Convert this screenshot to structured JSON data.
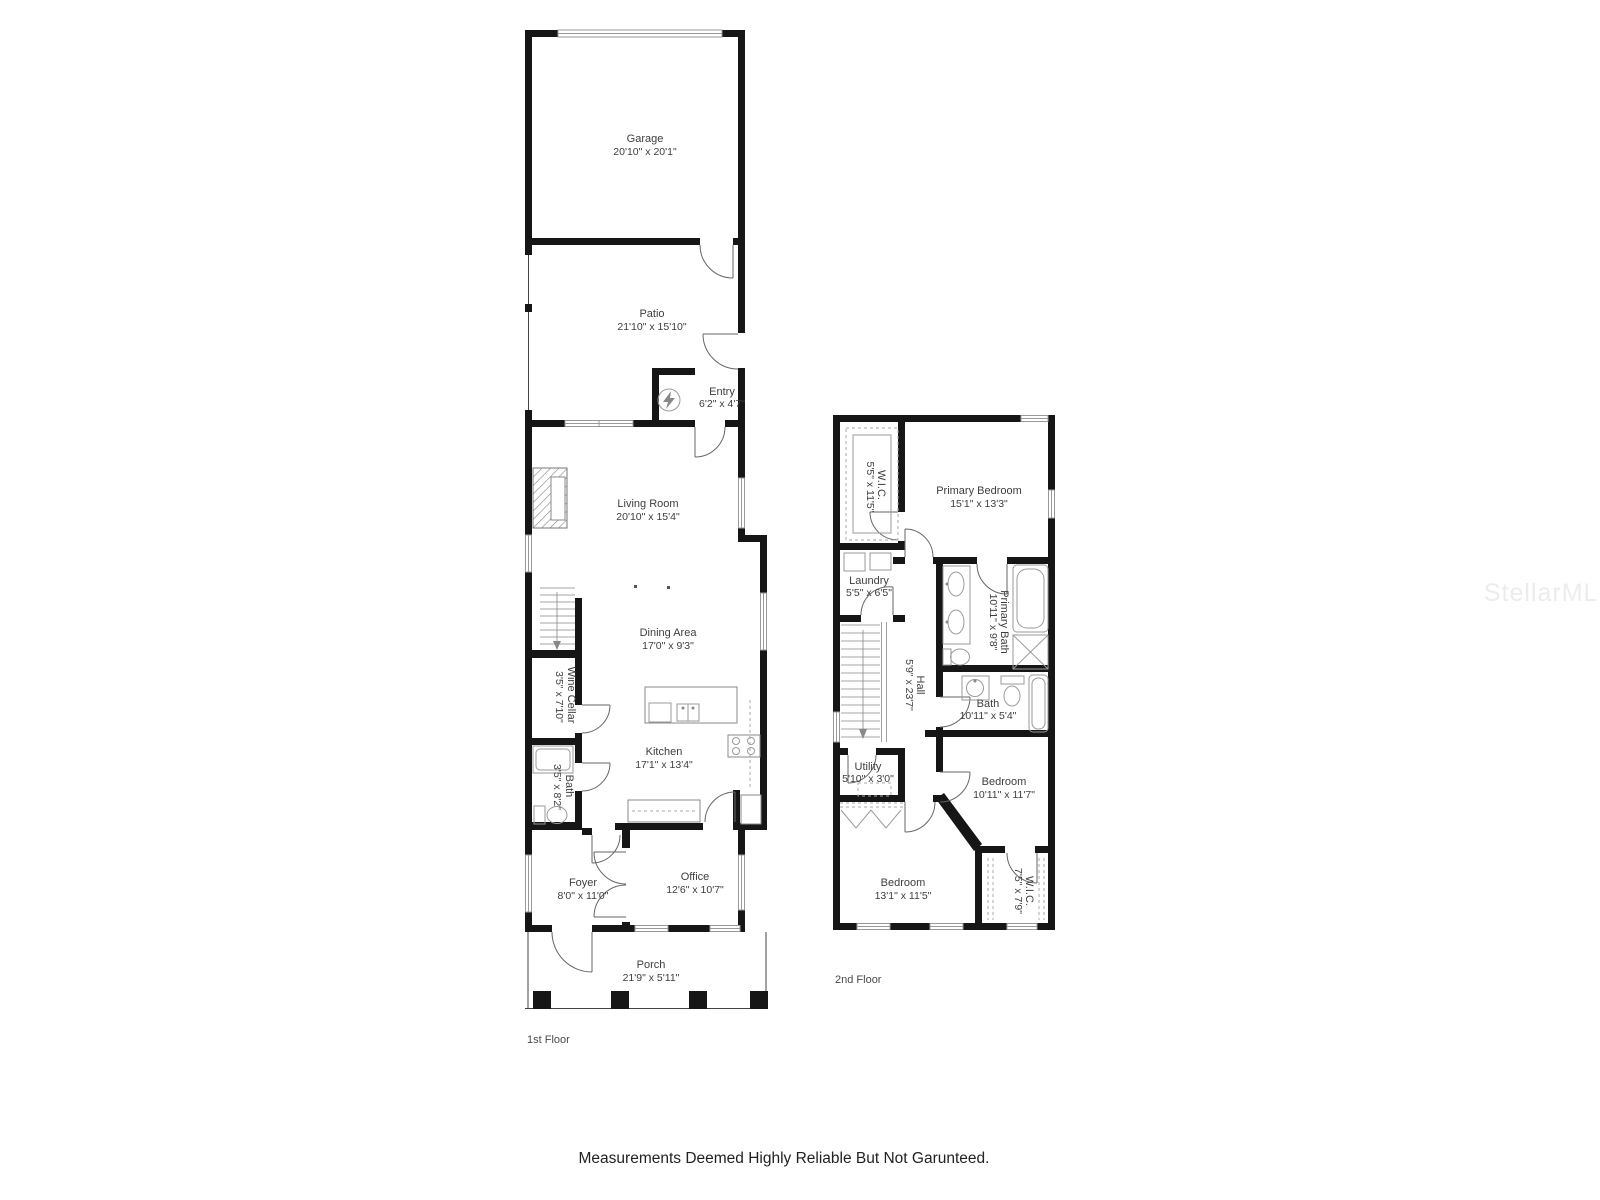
{
  "page": {
    "disclaimer": "Measurements Deemed Highly Reliable But Not Garunteed.",
    "watermark": "StellarMLS"
  },
  "first_floor": {
    "label": "1st Floor",
    "rooms": {
      "garage": {
        "name": "Garage",
        "dims": "20'10\" x 20'1\""
      },
      "patio": {
        "name": "Patio",
        "dims": "21'10\" x 15'10\""
      },
      "entry": {
        "name": "Entry",
        "dims": "6'2\" x 4'7\""
      },
      "living_room": {
        "name": "Living Room",
        "dims": "20'10\" x 15'4\""
      },
      "dining_area": {
        "name": "Dining Area",
        "dims": "17'0\" x 9'3\""
      },
      "wine_cellar": {
        "name": "Wine Cellar",
        "dims": "3'5\" x 7'10\""
      },
      "bath": {
        "name": "Bath",
        "dims": "3'5\" x 8'2\""
      },
      "kitchen": {
        "name": "Kitchen",
        "dims": "17'1\" x 13'4\""
      },
      "foyer": {
        "name": "Foyer",
        "dims": "8'0\" x 11'0\""
      },
      "office": {
        "name": "Office",
        "dims": "12'6\" x 10'7\""
      },
      "porch": {
        "name": "Porch",
        "dims": "21'9\" x 5'11\""
      }
    }
  },
  "second_floor": {
    "label": "2nd Floor",
    "rooms": {
      "wic_primary": {
        "name": "W.I.C.",
        "dims": "5'5\" x 11'5\""
      },
      "primary_bedroom": {
        "name": "Primary Bedroom",
        "dims": "15'1\" x 13'3\""
      },
      "laundry": {
        "name": "Laundry",
        "dims": "5'5\" x 6'5\""
      },
      "primary_bath": {
        "name": "Primary Bath",
        "dims": "10'11\" x 9'8\""
      },
      "hall": {
        "name": "Hall",
        "dims": "5'9\" x 23'7\""
      },
      "bath": {
        "name": "Bath",
        "dims": "10'11\" x 5'4\""
      },
      "utility": {
        "name": "Utility",
        "dims": "5'10\" x 3'0\""
      },
      "bedroom_right": {
        "name": "Bedroom",
        "dims": "10'11\" x 11'7\""
      },
      "bedroom_left": {
        "name": "Bedroom",
        "dims": "13'1\" x 11'5\""
      },
      "wic_secondary": {
        "name": "W.I.C.",
        "dims": "7'5\" x 7'9\""
      }
    }
  }
}
